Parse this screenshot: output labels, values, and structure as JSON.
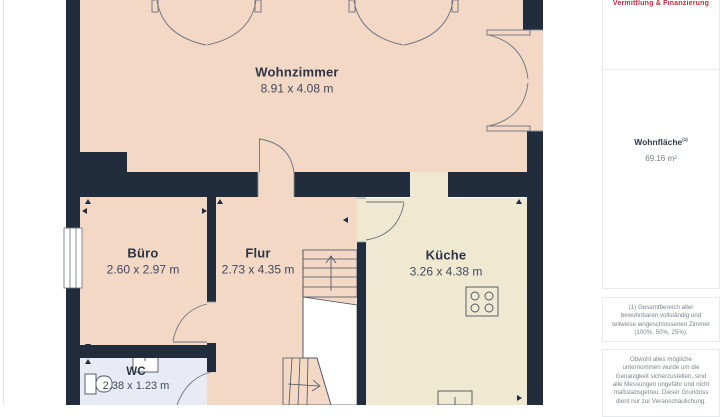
{
  "rooms": [
    {
      "id": "wohnzimmer",
      "name": "Wohnzimmer",
      "dims": "8.91 x 4.08 m"
    },
    {
      "id": "buero",
      "name": "Büro",
      "dims": "2.60 x 2.97 m"
    },
    {
      "id": "flur",
      "name": "Flur",
      "dims": "2.73 x 4.35 m"
    },
    {
      "id": "kueche",
      "name": "Küche",
      "dims": "3.26 x 4.38 m"
    },
    {
      "id": "wc",
      "name": "WC",
      "dims": "2.38 x 1.23 m"
    }
  ],
  "sidebar": {
    "logo_text": "Vermittlung & Finanzierung",
    "area_label": "Wohnfläche",
    "area_sup": "(1)",
    "area_value": "69.16 m²",
    "footnote": "(1) Gesamtbereich aller bewohnbaren vollständig und teilweise eingeschlossenen Zimmer (100%, 50%, 25%).",
    "disclaimer": "Obwohl alles mögliche unternommen wurde um die Genauigkeit sicherzustellen, sind alle Messungen ungefähr und nicht maßstabsgetreu. Dieser Grundriss dient nur zur Veranschaulichung."
  },
  "colors": {
    "wall": "#212d3c",
    "room_living": "#f2d8c5",
    "room_kitchen": "#f0e9d2",
    "room_wc": "#e8ebf3",
    "accent_red": "#c22a3c",
    "text_dark": "#2c3446",
    "text_gray": "#7d838d"
  }
}
